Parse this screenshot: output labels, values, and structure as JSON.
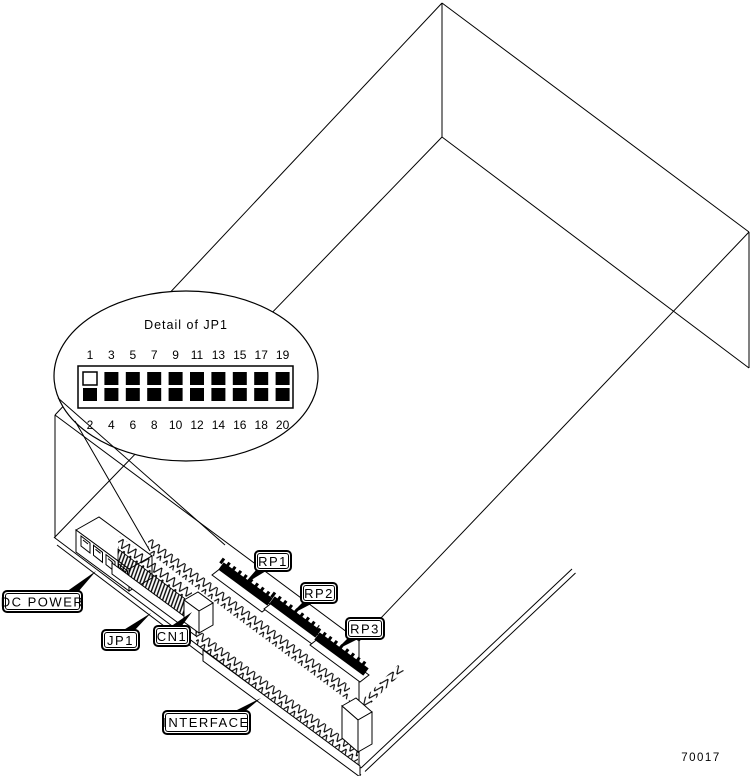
{
  "figure": {
    "number": "70017"
  },
  "detail_callout": {
    "title": "Detail of JP1",
    "top_pin_numbers": [
      "1",
      "3",
      "5",
      "7",
      "9",
      "11",
      "13",
      "15",
      "17",
      "19"
    ],
    "bottom_pin_numbers": [
      "2",
      "4",
      "6",
      "8",
      "10",
      "12",
      "14",
      "16",
      "18",
      "20"
    ],
    "open_pin": "1",
    "filled_pin_color": "#000000",
    "open_pin_color": "#ffffff"
  },
  "labels": {
    "dc_power": "DC POWER",
    "jp1": "JP1",
    "cn1": "CN1",
    "rp1": "RP1",
    "rp2": "RP2",
    "rp3": "RP3",
    "interface": "INTERFACE"
  },
  "colors": {
    "line": "#000000",
    "background": "#ffffff"
  }
}
